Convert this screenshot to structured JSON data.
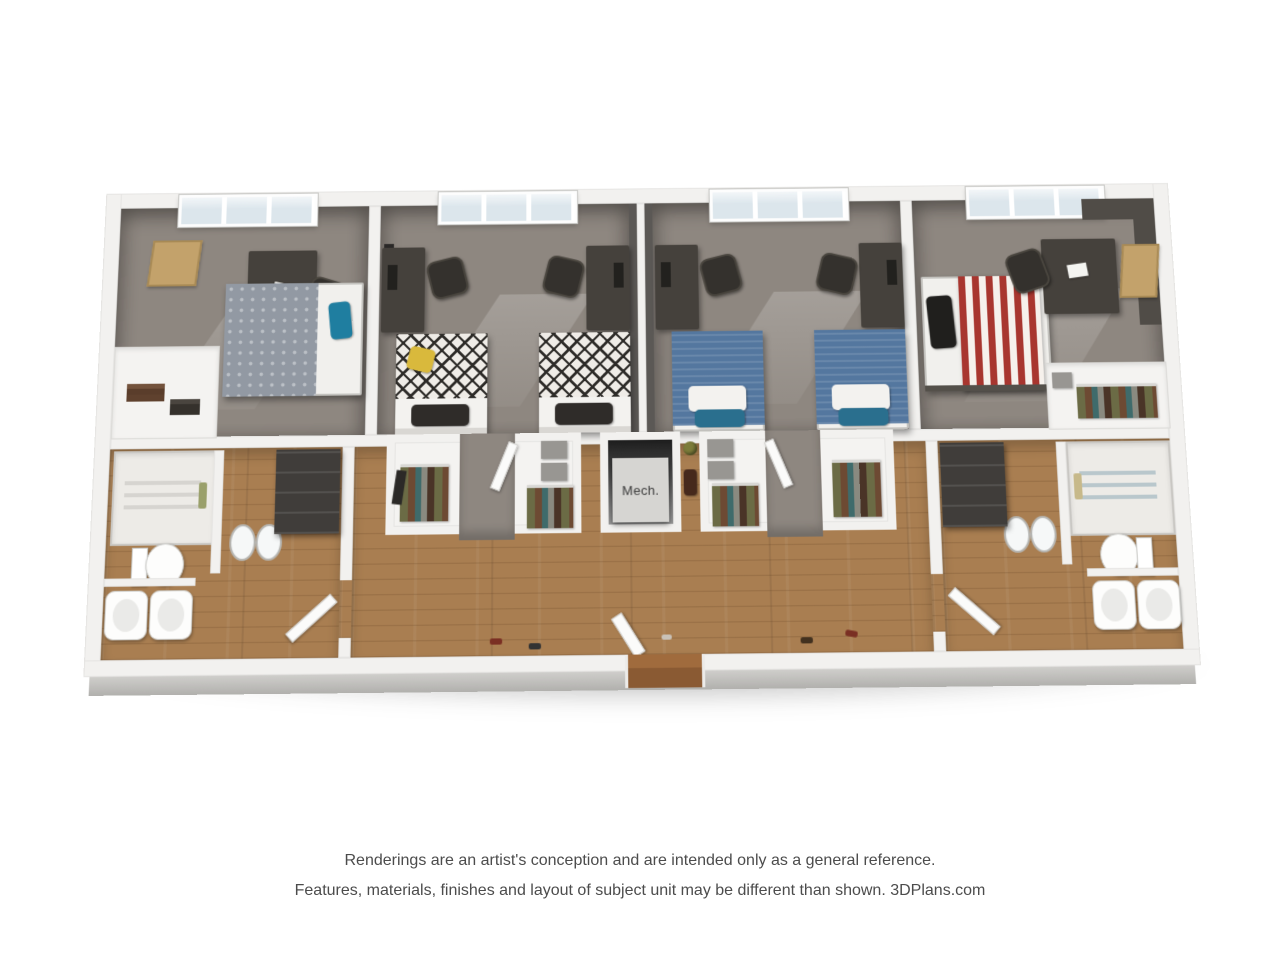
{
  "palette": {
    "wall": "#f2f1ef",
    "carpet": "#8e8780",
    "wood": "#a97e51",
    "charcoal": "#45413c",
    "bed-blue": "#54779f",
    "bed-red": "#a8362f",
    "bed-gray": "#9299a3",
    "accent-teal": "#1f7ea0",
    "accent-yellow": "#d9b93c",
    "glass": "#dce6ec",
    "cork": "#c3a26b",
    "mech-panel": "#d6d5d2",
    "door-brown": "#8a5a33"
  },
  "floorplan": {
    "mech_label": "Mech."
  },
  "disclaimer": {
    "line1": "Renderings are an artist's conception and are intended only as a general reference.",
    "line2": "Features, materials, finishes and layout of subject unit may be different than shown. 3DPlans.com"
  }
}
